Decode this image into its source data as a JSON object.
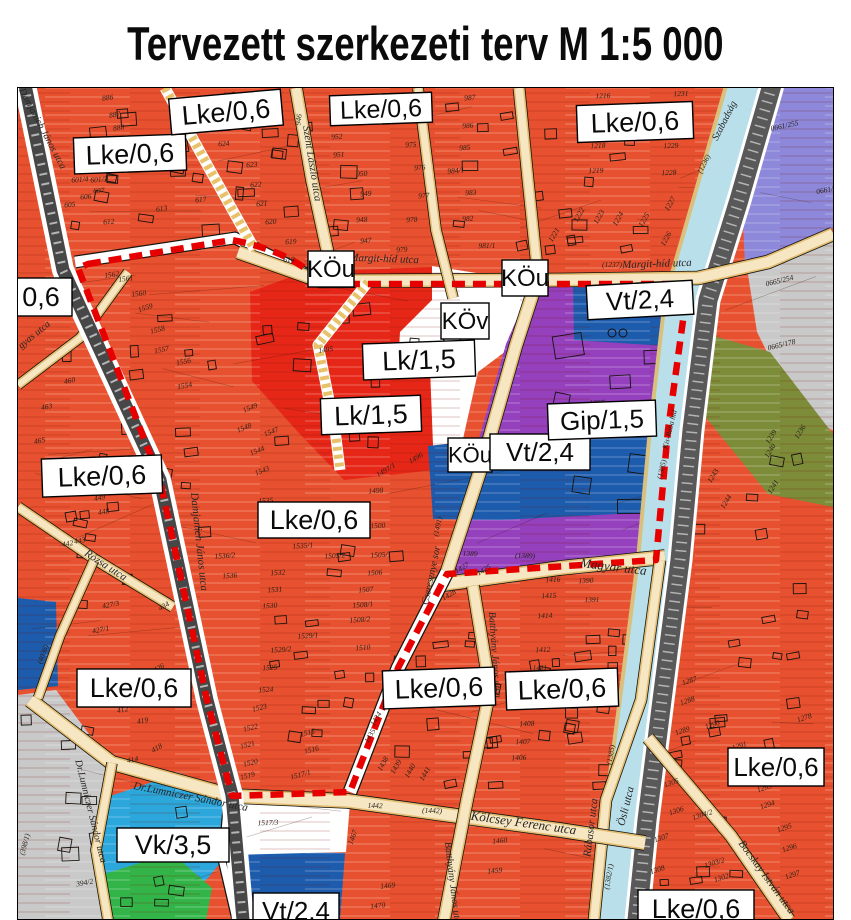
{
  "title": "Tervezett szerkezeti terv M 1:5 000",
  "map": {
    "colors": {
      "lke": "#e8512f",
      "lk": "#e62718",
      "gip": "#9540bd",
      "vt": "#1d5cad",
      "vk": "#2ba7dc",
      "park_green": "#33b448",
      "lavender": "#8d88da",
      "olive": "#7c8c39",
      "gray_zone": "#c9c9c9",
      "river": "#b9dfea",
      "road_fill": "#f6e7c2",
      "road_edge": "#e2bd72",
      "rail": "#474747",
      "dark_road": "#595959",
      "boundary": "#e70000",
      "white_zone": "#ffffff"
    },
    "zone_labels": [
      {
        "t": "Lke/0,6",
        "x": 130,
        "y": 154,
        "w": 112,
        "h": 36,
        "fs": 27,
        "r": -2
      },
      {
        "t": "Lke/0,6",
        "x": 226,
        "y": 112,
        "w": 112,
        "h": 36,
        "fs": 27,
        "r": -5
      },
      {
        "t": "Lke/0,6",
        "x": 381,
        "y": 109,
        "w": 102,
        "h": 30,
        "fs": 25,
        "r": -2
      },
      {
        "t": "Lke/0,6",
        "x": 635,
        "y": 122,
        "w": 116,
        "h": 37,
        "fs": 27,
        "r": -2
      },
      {
        "t": "0,6",
        "x": 41,
        "y": 297,
        "w": 62,
        "h": 38,
        "fs": 27,
        "r": 0
      },
      {
        "t": "Lke/0,6",
        "x": 102,
        "y": 476,
        "w": 120,
        "h": 38,
        "fs": 27,
        "r": -2
      },
      {
        "t": "Lke/0,6",
        "x": 314,
        "y": 520,
        "w": 112,
        "h": 36,
        "fs": 27,
        "r": 0
      },
      {
        "t": "Lk/1,5",
        "x": 419,
        "y": 360,
        "w": 112,
        "h": 36,
        "fs": 27,
        "r": -2
      },
      {
        "t": "Lk/1,5",
        "x": 371,
        "y": 415,
        "w": 100,
        "h": 36,
        "fs": 27,
        "r": -2
      },
      {
        "t": "KÖv",
        "x": 465,
        "y": 321,
        "w": 48,
        "h": 36,
        "fs": 24,
        "r": 0
      },
      {
        "t": "KÖu",
        "x": 331,
        "y": 269,
        "w": 46,
        "h": 36,
        "fs": 24,
        "r": 0
      },
      {
        "t": "KÖu",
        "x": 525,
        "y": 278,
        "w": 46,
        "h": 36,
        "fs": 24,
        "r": 0
      },
      {
        "t": "KÖu",
        "x": 470,
        "y": 455,
        "w": 44,
        "h": 34,
        "fs": 22,
        "r": 0
      },
      {
        "t": "Vt/2,4",
        "x": 540,
        "y": 452,
        "w": 100,
        "h": 36,
        "fs": 26,
        "r": 0
      },
      {
        "t": "Vt/2,4",
        "x": 640,
        "y": 300,
        "w": 106,
        "h": 34,
        "fs": 26,
        "r": -3
      },
      {
        "t": "Gip/1,5",
        "x": 602,
        "y": 420,
        "w": 108,
        "h": 36,
        "fs": 26,
        "r": -2
      },
      {
        "t": "Lke/0,6",
        "x": 134,
        "y": 688,
        "w": 114,
        "h": 38,
        "fs": 27,
        "r": 0
      },
      {
        "t": "Lke/0,6",
        "x": 439,
        "y": 688,
        "w": 112,
        "h": 38,
        "fs": 27,
        "r": -2
      },
      {
        "t": "Lke/0,6",
        "x": 562,
        "y": 689,
        "w": 112,
        "h": 38,
        "fs": 27,
        "r": -2
      },
      {
        "t": "Lke/0,6",
        "x": 776,
        "y": 767,
        "w": 96,
        "h": 38,
        "fs": 26,
        "r": 0
      },
      {
        "t": "Vk/3,5",
        "x": 173,
        "y": 845,
        "w": 112,
        "h": 34,
        "fs": 27,
        "r": 0
      },
      {
        "t": "Vt/2,4",
        "x": 296,
        "y": 911,
        "w": 86,
        "h": 36,
        "fs": 26,
        "r": 0
      },
      {
        "t": "Lke/0,6",
        "x": 696,
        "y": 909,
        "w": 116,
        "h": 38,
        "fs": 27,
        "r": 0
      }
    ],
    "street_labels": [
      {
        "t": "Szent László utca",
        "x": 309,
        "y": 164,
        "r": 81,
        "fs": 11
      },
      {
        "t": "Margit-híd utca",
        "x": 384,
        "y": 262,
        "r": 2,
        "fs": 11
      },
      {
        "t": "Margit-híd utca",
        "x": 657,
        "y": 267,
        "r": -2,
        "fs": 11
      },
      {
        "t": "Szabadság",
        "x": 727,
        "y": 122,
        "r": -63,
        "fs": 10
      },
      {
        "t": "Magyar utca",
        "x": 613,
        "y": 571,
        "r": 7,
        "fs": 13
      },
      {
        "t": "Cseresznye sor",
        "x": 434,
        "y": 576,
        "r": -78,
        "fs": 10
      },
      {
        "t": "Kölcsey Ferenc utca",
        "x": 523,
        "y": 827,
        "r": 8,
        "fs": 13
      },
      {
        "t": "Rábasor utca",
        "x": 594,
        "y": 828,
        "r": -83,
        "fs": 11
      },
      {
        "t": "Ösli utca",
        "x": 629,
        "y": 807,
        "r": -76,
        "fs": 11
      },
      {
        "t": "Damjanich János utca",
        "x": 196,
        "y": 542,
        "r": 84,
        "fs": 11
      },
      {
        "t": "Damjanich János utca",
        "x": 40,
        "y": 130,
        "r": 62,
        "fs": 10
      },
      {
        "t": "Rózsa utca",
        "x": 104,
        "y": 568,
        "r": 33,
        "fs": 11
      },
      {
        "t": "Dr.Lumniczer Sándor utca",
        "x": 190,
        "y": 800,
        "r": 11,
        "fs": 11
      },
      {
        "t": "Dr.Lumniczer Sándor utca",
        "x": 88,
        "y": 812,
        "r": 76,
        "fs": 10
      },
      {
        "t": "Bocskay István utca",
        "x": 764,
        "y": 879,
        "r": 54,
        "fs": 11
      },
      {
        "t": "Batthyány János utca",
        "x": 492,
        "y": 655,
        "r": 86,
        "fs": 10
      },
      {
        "t": "Batthyány János utca",
        "x": 450,
        "y": 885,
        "r": 83,
        "fs": 10
      },
      {
        "t": "gyas utca",
        "x": 36,
        "y": 337,
        "r": -39,
        "fs": 10
      }
    ],
    "annotations": [
      [
        "886",
        108,
        100,
        -8
      ],
      [
        "887",
        115,
        117,
        -8
      ],
      [
        "888",
        119,
        130,
        -8
      ],
      [
        "899",
        126,
        143,
        -8
      ],
      [
        "601/4",
        80,
        182,
        -4
      ],
      [
        "601/3",
        99,
        182,
        -4
      ],
      [
        "605",
        70,
        207,
        -4
      ],
      [
        "606",
        86,
        199,
        -4
      ],
      [
        "607",
        99,
        193,
        -4
      ],
      [
        "612",
        109,
        224,
        -4
      ],
      [
        "613",
        162,
        211,
        -8
      ],
      [
        "617",
        201,
        202,
        -4
      ],
      [
        "618",
        289,
        262,
        -2
      ],
      [
        "619",
        291,
        244,
        -3
      ],
      [
        "620",
        271,
        224,
        -4
      ],
      [
        "621",
        262,
        206,
        -4
      ],
      [
        "622",
        256,
        187,
        -4
      ],
      [
        "623",
        252,
        167,
        -4
      ],
      [
        "624",
        224,
        146,
        -4
      ],
      [
        "625",
        226,
        131,
        -4
      ],
      [
        "627",
        229,
        97,
        -2
      ],
      [
        "946",
        301,
        120,
        -82
      ],
      [
        "947",
        366,
        243,
        -4
      ],
      [
        "948",
        362,
        222,
        -4
      ],
      [
        "949",
        366,
        196,
        -4
      ],
      [
        "950",
        362,
        176,
        -4
      ],
      [
        "951",
        339,
        157,
        -4
      ],
      [
        "952",
        337,
        139,
        -4
      ],
      [
        "975",
        411,
        147,
        -4
      ],
      [
        "976",
        420,
        170,
        -4
      ],
      [
        "977",
        424,
        198,
        -4
      ],
      [
        "978",
        412,
        222,
        -4
      ],
      [
        "979",
        402,
        252,
        -4
      ],
      [
        "981/1",
        487,
        248,
        -2
      ],
      [
        "982",
        468,
        221,
        -4
      ],
      [
        "983",
        471,
        195,
        -4
      ],
      [
        "984/1",
        456,
        173,
        -4
      ],
      [
        "985",
        465,
        150,
        -4
      ],
      [
        "986",
        468,
        128,
        -4
      ],
      [
        "987",
        470,
        100,
        -4
      ],
      [
        "1216",
        603,
        98,
        -2
      ],
      [
        "1231",
        681,
        96,
        -2
      ],
      [
        "1218",
        598,
        148,
        -2
      ],
      [
        "1229",
        671,
        148,
        -2
      ],
      [
        "1219",
        596,
        173,
        -2
      ],
      [
        "1228",
        669,
        175,
        -2
      ],
      [
        "1221",
        556,
        236,
        -60
      ],
      [
        "1222",
        581,
        216,
        -60
      ],
      [
        "1223",
        601,
        218,
        -60
      ],
      [
        "1224",
        620,
        220,
        -60
      ],
      [
        "1225",
        646,
        221,
        -60
      ],
      [
        "1227",
        672,
        205,
        -60
      ],
      [
        "1226",
        668,
        240,
        -60
      ],
      [
        "0661/255",
        785,
        128,
        -12
      ],
      [
        "0661/2",
        827,
        192,
        -12
      ],
      [
        "0665/254",
        780,
        283,
        -14
      ],
      [
        "0665/178",
        782,
        347,
        -14
      ],
      [
        "1236",
        802,
        433,
        -58
      ],
      [
        "1239",
        773,
        438,
        -58
      ],
      [
        "1240",
        772,
        452,
        -58
      ],
      [
        "1241",
        775,
        488,
        -58
      ],
      [
        "1243",
        715,
        477,
        -58
      ],
      [
        "1244",
        728,
        503,
        -58
      ],
      [
        "1495",
        326,
        352,
        -8
      ],
      [
        "1494",
        430,
        350,
        0
      ],
      [
        "1397",
        597,
        405,
        -2
      ],
      [
        "1562",
        112,
        277,
        -8
      ],
      [
        "1561",
        126,
        281,
        -8
      ],
      [
        "1560",
        139,
        296,
        -8
      ],
      [
        "1559",
        146,
        310,
        -18
      ],
      [
        "1558",
        158,
        332,
        -14
      ],
      [
        "1557",
        162,
        352,
        -12
      ],
      [
        "1556",
        184,
        364,
        -12
      ],
      [
        "1554",
        185,
        388,
        -10
      ],
      [
        "1549",
        251,
        410,
        -22
      ],
      [
        "1548",
        245,
        430,
        -22
      ],
      [
        "1547",
        272,
        434,
        -22
      ],
      [
        "1544",
        258,
        453,
        -22
      ],
      [
        "1543",
        263,
        473,
        -22
      ],
      [
        "1535",
        266,
        503,
        -4
      ],
      [
        "1537",
        296,
        530,
        -4
      ],
      [
        "1535/1",
        303,
        548,
        -4
      ],
      [
        "1536/2",
        225,
        558,
        -4
      ],
      [
        "1536",
        230,
        578,
        -4
      ],
      [
        "1532",
        278,
        575,
        -4
      ],
      [
        "1531",
        275,
        592,
        -4
      ],
      [
        "1530",
        270,
        608,
        -4
      ],
      [
        "1529/1",
        308,
        638,
        -4
      ],
      [
        "1529/2",
        281,
        652,
        -4
      ],
      [
        "1525",
        270,
        670,
        -4
      ],
      [
        "1524",
        266,
        692,
        -4
      ],
      [
        "1505/2",
        335,
        558,
        -4
      ],
      [
        "1505/1",
        381,
        557,
        -4
      ],
      [
        "1506",
        375,
        575,
        -4
      ],
      [
        "1507",
        366,
        592,
        -4
      ],
      [
        "1508/1",
        363,
        607,
        -4
      ],
      [
        "1508/2",
        360,
        622,
        -4
      ],
      [
        "1510",
        363,
        650,
        -4
      ],
      [
        "1500",
        378,
        528,
        -4
      ],
      [
        "1498",
        376,
        493,
        -4
      ],
      [
        "1496",
        417,
        460,
        -30
      ],
      [
        "1497/1",
        387,
        472,
        -30
      ],
      [
        "449",
        100,
        500,
        -10
      ],
      [
        "448",
        104,
        514,
        -10
      ],
      [
        "442",
        68,
        546,
        -10
      ],
      [
        "443",
        80,
        543,
        -10
      ],
      [
        "465",
        40,
        443,
        -10
      ],
      [
        "460",
        70,
        383,
        -10
      ],
      [
        "463",
        47,
        409,
        -10
      ],
      [
        "434",
        165,
        608,
        -30
      ],
      [
        "426",
        160,
        670,
        -30
      ],
      [
        "427/3",
        111,
        607,
        -10
      ],
      [
        "427/1",
        101,
        632,
        -10
      ],
      [
        "412",
        123,
        712,
        -10
      ],
      [
        "420",
        178,
        703,
        -10
      ],
      [
        "419",
        143,
        723,
        -10
      ],
      [
        "418",
        158,
        750,
        -30
      ],
      [
        "414",
        133,
        762,
        -10
      ],
      [
        "1523",
        260,
        710,
        -14
      ],
      [
        "1522",
        251,
        730,
        -14
      ],
      [
        "1521",
        248,
        747,
        -14
      ],
      [
        "1520",
        251,
        765,
        -14
      ],
      [
        "1519",
        248,
        778,
        -14
      ],
      [
        "1517/1",
        301,
        777,
        -14
      ],
      [
        "1516",
        312,
        752,
        -14
      ],
      [
        "1515",
        308,
        735,
        -14
      ],
      [
        "1517/3",
        268,
        825,
        -2
      ],
      [
        "394/2",
        85,
        885,
        -10
      ],
      [
        "403/1",
        148,
        836,
        -10
      ],
      [
        "1427",
        463,
        570,
        -30
      ],
      [
        "1428",
        450,
        597,
        -30
      ],
      [
        "1425",
        485,
        572,
        -30
      ],
      [
        "1412",
        543,
        652,
        -2
      ],
      [
        "1411",
        540,
        670,
        -2
      ],
      [
        "1408",
        527,
        726,
        -2
      ],
      [
        "1407",
        523,
        744,
        -2
      ],
      [
        "1406",
        519,
        760,
        -2
      ],
      [
        "1416",
        553,
        582,
        -2
      ],
      [
        "1415",
        549,
        598,
        -2
      ],
      [
        "1414",
        545,
        618,
        -2
      ],
      [
        "1390",
        586,
        583,
        -2
      ],
      [
        "1391",
        592,
        602,
        -2
      ],
      [
        "1435",
        372,
        737,
        -60
      ],
      [
        "1434",
        378,
        720,
        -60
      ],
      [
        "1438",
        385,
        765,
        -60
      ],
      [
        "1439",
        398,
        768,
        -60
      ],
      [
        "1440",
        412,
        772,
        -60
      ],
      [
        "1441",
        427,
        775,
        -60
      ],
      [
        "1459",
        495,
        873,
        -6
      ],
      [
        "1460",
        500,
        843,
        -6
      ],
      [
        "1469",
        388,
        888,
        -6
      ],
      [
        "1470",
        378,
        908,
        -6
      ],
      [
        "1467",
        355,
        838,
        -70
      ],
      [
        "1442",
        375,
        808,
        2
      ],
      [
        "(1442)",
        432,
        813,
        2
      ],
      [
        "1287",
        690,
        683,
        -18
      ],
      [
        "1288",
        688,
        703,
        -18
      ],
      [
        "1289",
        683,
        733,
        -18
      ],
      [
        "1290",
        713,
        727,
        -18
      ],
      [
        "1278",
        805,
        720,
        -18
      ],
      [
        "1291",
        740,
        748,
        -18
      ],
      [
        "1293",
        765,
        790,
        -18
      ],
      [
        "1294",
        768,
        807,
        -18
      ],
      [
        "1295",
        785,
        830,
        -18
      ],
      [
        "1296",
        790,
        850,
        -18
      ],
      [
        "1297",
        793,
        877,
        -18
      ],
      [
        "1305",
        672,
        785,
        -18
      ],
      [
        "1306",
        677,
        813,
        -18
      ],
      [
        "1307",
        662,
        840,
        -18
      ],
      [
        "1308",
        658,
        872,
        -18
      ],
      [
        "1309",
        653,
        898,
        -18
      ],
      [
        "1304/2",
        703,
        817,
        -18
      ],
      [
        "1303/2",
        715,
        865,
        -18
      ],
      [
        "1302",
        722,
        880,
        -18
      ],
      [
        "(616)",
        333,
        264,
        0
      ],
      [
        "(1237)",
        612,
        267,
        0
      ],
      [
        "(1389)",
        525,
        558,
        2
      ],
      [
        "1389",
        470,
        556,
        2
      ],
      [
        "(1236)",
        706,
        165,
        -63
      ],
      [
        "(1385)",
        664,
        470,
        -76
      ],
      [
        "Kis-Rába híd",
        672,
        430,
        -76
      ],
      [
        "(1385)",
        613,
        755,
        -80
      ],
      [
        "(1382/1)",
        611,
        877,
        -80
      ],
      [
        "(4036)",
        45,
        655,
        -70
      ],
      [
        "(398/1)",
        27,
        845,
        -75
      ],
      [
        "(1491)",
        440,
        527,
        -78
      ]
    ]
  }
}
